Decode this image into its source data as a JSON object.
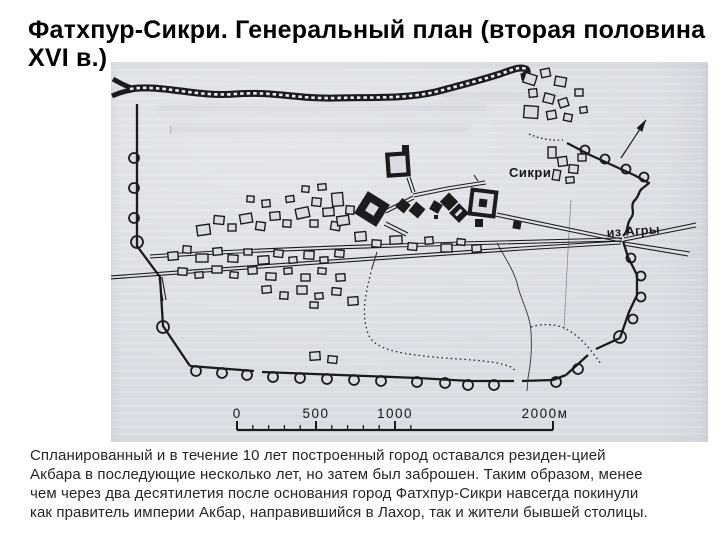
{
  "title": {
    "lines": [
      "Фатхпур-Сикри. Генеральный план (вторая половина",
      "XVI в.)"
    ]
  },
  "map": {
    "labels": {
      "sikri": "Сикри",
      "from_agra": "из Агры"
    },
    "scale_bar": {
      "labels": [
        "0",
        "500",
        "1000",
        "2000м"
      ]
    },
    "colors": {
      "paper": "#d9dce2",
      "ink": "#1c1c1e"
    }
  },
  "caption": {
    "lines": [
      "Спланированный и в течение 10 лет построенный город оставался резиден-цией",
      "Акбара в последующие несколько лет, но затем был заброшен. Таким образом, менее",
      "чем через два десятилетия после основания город Фатхпур-Сикри навсегда покинули",
      "как правитель империи Акбар, направившийся в Лахор, так и жители бывшей столицы."
    ]
  }
}
